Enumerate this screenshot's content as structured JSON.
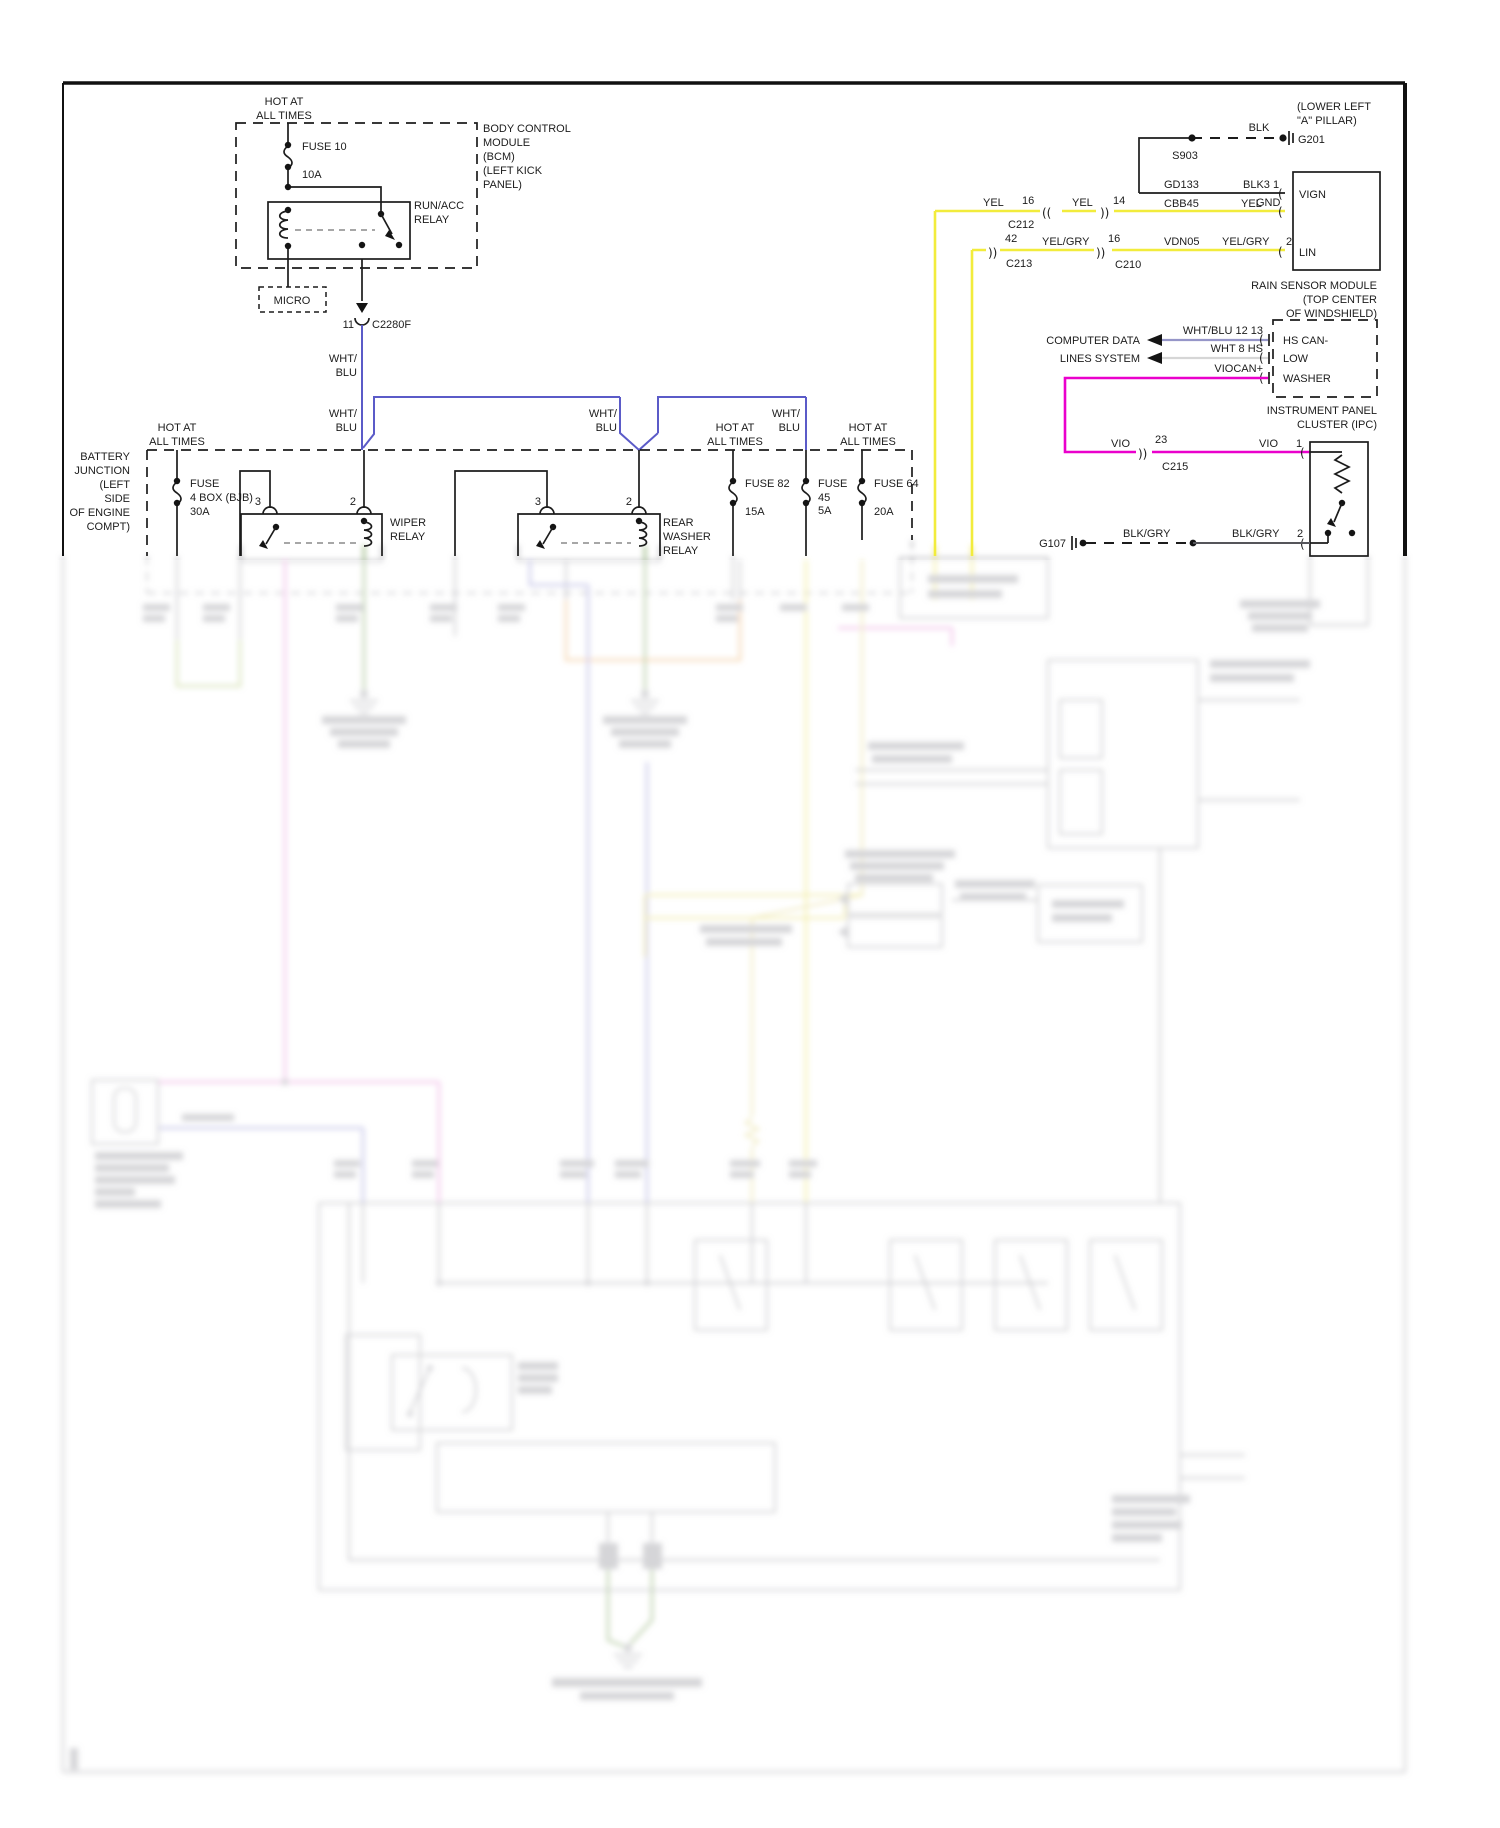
{
  "colors": {
    "wire_black": "#1c1c1c",
    "wire_wht_blu": "#5b5bc8",
    "wire_yellow": "#f2ec3c",
    "wire_violet": "#ea00cc",
    "wire_wht_blu_data": "#9696c8",
    "wire_wht_data": "#d6d6d6",
    "wire_blk_gry": "#55555a"
  },
  "bcm": {
    "hot1": "HOT AT",
    "hot2": "ALL TIMES",
    "fuse": "FUSE 10",
    "amps": "10A",
    "relay_l1": "RUN/ACC",
    "relay_l2": "RELAY",
    "micro": "MICRO",
    "pin": "11",
    "connector": "C2280F",
    "title": [
      "BODY CONTROL",
      "MODULE",
      "(BCM)",
      "(LEFT KICK",
      "PANEL)"
    ]
  },
  "wire_labels": {
    "wht": "WHT/",
    "blu": "BLU"
  },
  "g201": {
    "loc1": "(LOWER LEFT",
    "loc2": "\"A\" PILLAR)",
    "color": "BLK",
    "splice": "S903",
    "ground": "G201"
  },
  "rain": {
    "title": [
      "RAIN SENSOR MODULE",
      "(TOP CENTER",
      "OF WINDSHIELD)"
    ],
    "row1": {
      "circuit": "GD133",
      "color_pins": "BLK3 1",
      "pin_name": "VIGN"
    },
    "row2": {
      "circuit": "CBB45",
      "color": "YEL",
      "overlap": "GND"
    },
    "row3": {
      "circuit": "VDN05",
      "color": "YEL/GRY",
      "pin": "2",
      "pin_name": "LIN"
    },
    "c212": {
      "left_color": "YEL",
      "left_pin": "16",
      "name": "C212",
      "right_color": "YEL",
      "right_pin": "14"
    },
    "c213": {
      "left_pin": "42",
      "name": "C213",
      "mid_color": "YEL/GRY",
      "right_pin": "16",
      "right_name": "C210"
    }
  },
  "data_lines": {
    "label1": "COMPUTER DATA",
    "label2": "LINES SYSTEM",
    "rows": [
      {
        "label": "WHT/BLU 12 13",
        "pin_name": "HS CAN-"
      },
      {
        "label": "WHT 8 HS",
        "pin_name": "LOW"
      },
      {
        "label": "VIOCAN+",
        "pin_name": "WASHER"
      }
    ]
  },
  "ipc": {
    "title1": "INSTRUMENT PANEL",
    "title2": "CLUSTER (IPC)",
    "vio_row": {
      "color_a": "VIO",
      "pin_a": "23",
      "connector": "C215",
      "color_b": "VIO",
      "pin_b": "1"
    },
    "gnd_row": {
      "ground": "G107",
      "color_a": "BLK/GRY",
      "color_b": "BLK/GRY",
      "pin": "2"
    }
  },
  "bjb": {
    "title": [
      "BATTERY",
      "JUNCTION",
      "(LEFT",
      "SIDE",
      "OF ENGINE",
      "COMPT)"
    ],
    "hot1": "HOT AT",
    "hot2": "ALL TIMES",
    "fuse4": {
      "l1": "FUSE",
      "l2": "4 BOX (BJB)",
      "l3": "30A"
    },
    "wiper_relay": {
      "l1": "WIPER",
      "l2": "RELAY"
    },
    "rear_relay": {
      "l1": "REAR",
      "l2": "WASHER",
      "l3": "RELAY"
    },
    "pin3": "3",
    "pin2": "2",
    "fuse82": {
      "l1": "FUSE 82",
      "l2": "15A"
    },
    "fuse45": {
      "l1": "FUSE",
      "l2": "45",
      "l3": "5A"
    },
    "fuse64": {
      "l1": "FUSE 64",
      "l2": "20A"
    }
  }
}
